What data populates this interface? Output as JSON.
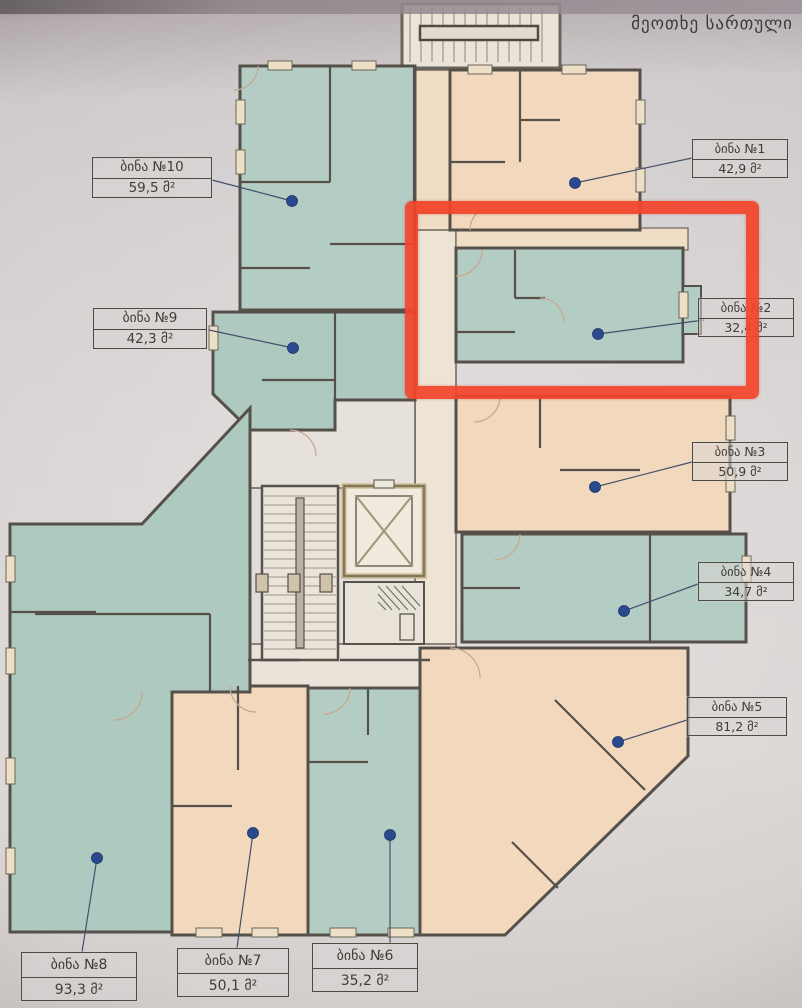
{
  "title": "მეოთხე სართული",
  "apartments": [
    {
      "id": 1,
      "name": "ბინა №1",
      "area": "42,9 მ²"
    },
    {
      "id": 2,
      "name": "ბინა №2",
      "area": "32,4 მ²"
    },
    {
      "id": 3,
      "name": "ბინა №3",
      "area": "50,9 მ²"
    },
    {
      "id": 4,
      "name": "ბინა №4",
      "area": "34,7 მ²"
    },
    {
      "id": 5,
      "name": "ბინა №5",
      "area": "81,2 მ²"
    },
    {
      "id": 6,
      "name": "ბინა №6",
      "area": "35,2 მ²"
    },
    {
      "id": 7,
      "name": "ბინა №7",
      "area": "50,1 მ²"
    },
    {
      "id": 8,
      "name": "ბინა №8",
      "area": "93,3 მ²"
    },
    {
      "id": 9,
      "name": "ბინა №9",
      "area": "42,3 მ²"
    },
    {
      "id": 10,
      "name": "ბინა №10",
      "area": "59,5 მ²"
    }
  ],
  "highlight": {
    "apartment": "ბინა №2",
    "color": "#f4452d"
  },
  "colors": {
    "room_teal": "#b3cdc4",
    "room_peach": "#f2d9bd",
    "corridor": "#e8e2d9",
    "wall_dark": "#55514a",
    "wall_tan": "#d5c4a1",
    "marker_dot": "#2a4a8f",
    "paper": "#d8d3d3"
  }
}
